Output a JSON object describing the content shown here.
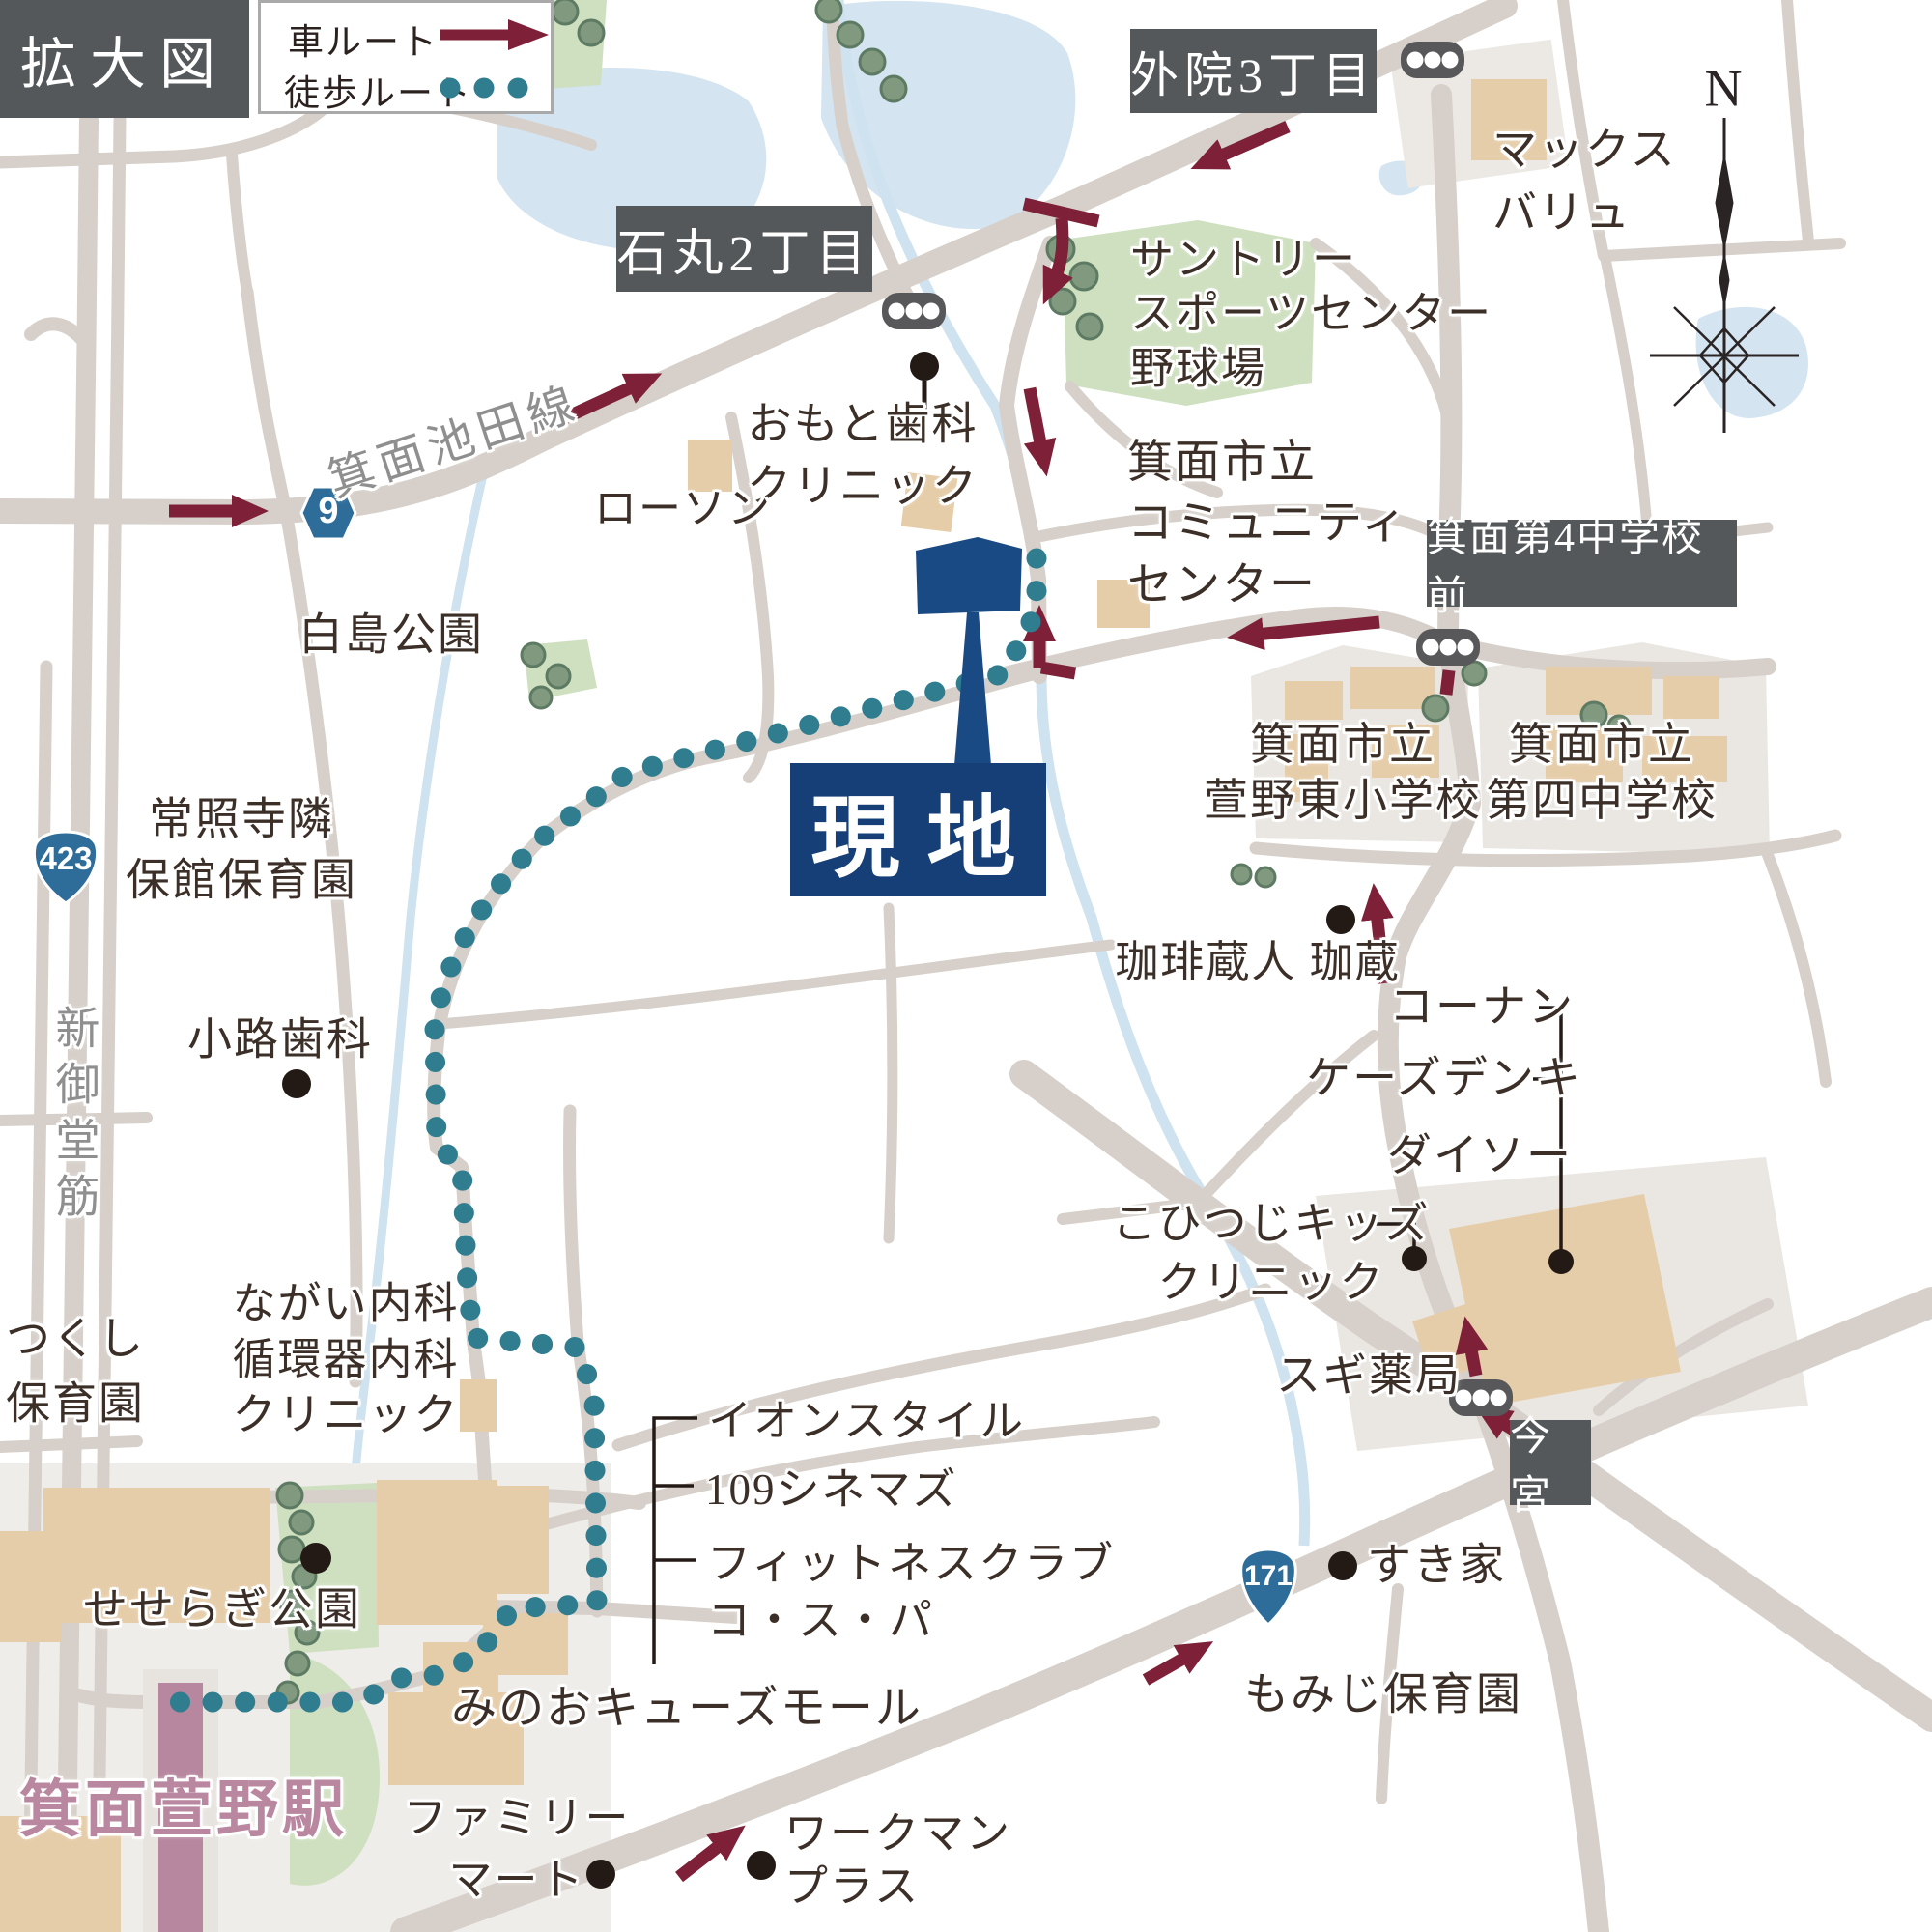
{
  "map": {
    "title_box": "拡大図",
    "legend": {
      "car_label": "車ルート",
      "walk_label": "徒歩ルート"
    },
    "site_label": "現地",
    "compass_north": "N",
    "station_name": "箕面萱野駅",
    "intersections": {
      "ishimaru": "石丸2丁目",
      "gein": "外院3丁目",
      "minoh4": "箕面第4中学校前",
      "imamiya": "今宮"
    },
    "route_shields": {
      "r9": "9",
      "r423": "423",
      "r171": "171"
    },
    "road_names": {
      "ikeda_line": "箕面池田線",
      "shin_midosuji": "新御堂筋"
    },
    "places": {
      "max_valu": "マックス\nバリュ",
      "suntory": "サントリー\nスポーツセンター\n野球場",
      "community_center": "箕面市立\nコミュニティ\nセンター",
      "omoto_dental": "おもと歯科\nクリニック",
      "lawson": "ローソン",
      "hakushima_park": "白島公園",
      "joshoji_nursery": "常照寺隣\n保館保育園",
      "tsukushi_nursery": "つくし\n保育園",
      "shoji_dental": "小路歯科",
      "nagai_clinic": "ながい内科\n循環器内科\nクリニック",
      "seseragi_park": "せせらぎ公園",
      "kayano_east_elem": "箕面市立\n萱野東小学校",
      "dai4_junior": "箕面市立\n第四中学校",
      "coffee_kurando": "珈琲蔵人 珈蔵",
      "konan": "コーナン",
      "ks_denki": "ケーズデンキ",
      "daiso": "ダイソー",
      "kohitsuji_clinic": "こひつじキッズ\nクリニック",
      "sugi_pharmacy": "スギ薬局",
      "sukiya": "すき家",
      "momiji_nursery": "もみじ保育園",
      "aeon_style": "イオンスタイル",
      "cinemas_109": "109シネマズ",
      "fitness_cospa": "フィットネスクラブ\nコ・ス・パ",
      "qs_mall": "みのおキューズモール",
      "family_mart": "ファミリー\nマート",
      "workman_plus": "ワークマン\nプラス"
    },
    "colors": {
      "car_route": "#7d2038",
      "walk_route": "#2f7d8e",
      "site_blue": "#163f77",
      "shield_blue": "#2e6d99",
      "station_pink": "#b9879f",
      "road_gray": "#d7d0ca",
      "sign_gray": "#54585a"
    }
  }
}
